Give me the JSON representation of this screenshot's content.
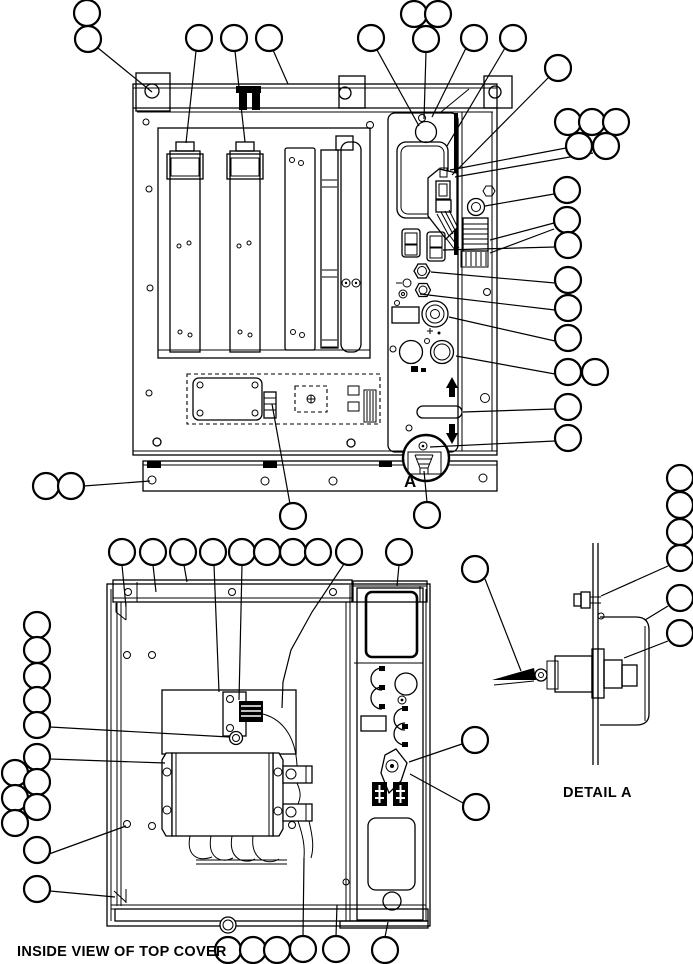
{
  "figure": {
    "type": "exploded-parts-diagram",
    "background_color": "#ffffff",
    "line_color": "#000000"
  },
  "captions": {
    "inside_view": "INSIDE VIEW OF TOP COVER",
    "detail_a": "DETAIL A",
    "detail_marker_a": "A"
  },
  "callouts": {
    "radius": 13,
    "stroke_width": 2.2,
    "fill": "#ffffff",
    "balloons": [
      [
        87,
        13
      ],
      [
        88,
        39
      ],
      [
        199,
        38
      ],
      [
        234,
        38
      ],
      [
        269,
        38
      ],
      [
        371,
        38
      ],
      [
        414,
        14
      ],
      [
        438,
        14
      ],
      [
        426,
        39
      ],
      [
        474,
        38
      ],
      [
        513,
        38
      ],
      [
        558,
        68
      ],
      [
        568,
        122
      ],
      [
        592,
        122
      ],
      [
        616,
        122
      ],
      [
        579,
        146
      ],
      [
        606,
        146
      ],
      [
        567,
        190
      ],
      [
        567,
        220
      ],
      [
        568,
        245
      ],
      [
        568,
        280
      ],
      [
        568,
        308
      ],
      [
        568,
        338
      ],
      [
        568,
        372
      ],
      [
        595,
        372
      ],
      [
        568,
        407
      ],
      [
        568,
        438
      ],
      [
        46,
        486
      ],
      [
        71,
        486
      ],
      [
        293,
        516
      ],
      [
        427,
        515
      ],
      [
        122,
        552
      ],
      [
        153,
        552
      ],
      [
        183,
        552
      ],
      [
        213,
        552
      ],
      [
        242,
        552
      ],
      [
        267,
        552
      ],
      [
        293,
        552
      ],
      [
        318,
        552
      ],
      [
        349,
        552
      ],
      [
        399,
        552
      ],
      [
        475,
        569
      ],
      [
        37,
        625
      ],
      [
        37,
        650
      ],
      [
        37,
        676
      ],
      [
        37,
        700
      ],
      [
        37,
        725
      ],
      [
        37,
        757
      ],
      [
        15,
        773
      ],
      [
        37,
        782
      ],
      [
        15,
        798
      ],
      [
        37,
        807
      ],
      [
        15,
        823
      ],
      [
        37,
        850
      ],
      [
        37,
        889
      ],
      [
        228,
        950
      ],
      [
        253,
        950
      ],
      [
        277,
        950
      ],
      [
        303,
        949
      ],
      [
        336,
        949
      ],
      [
        385,
        950
      ],
      [
        475,
        740
      ],
      [
        476,
        807
      ],
      [
        680,
        478
      ],
      [
        680,
        505
      ],
      [
        680,
        532
      ],
      [
        680,
        558
      ],
      [
        680,
        598
      ],
      [
        680,
        633
      ]
    ]
  },
  "leaders": {
    "stroke_width": 1.2,
    "lines": [
      [
        [
          98,
          48
        ],
        [
          152,
          92
        ]
      ],
      [
        [
          196,
          51
        ],
        [
          186,
          143
        ]
      ],
      [
        [
          235,
          51
        ],
        [
          245,
          142
        ]
      ],
      [
        [
          273,
          50
        ],
        [
          288,
          84
        ]
      ],
      [
        [
          377,
          50
        ],
        [
          419,
          126
        ]
      ],
      [
        [
          426,
          52
        ],
        [
          424,
          119
        ]
      ],
      [
        [
          466,
          48
        ],
        [
          432,
          117
        ]
      ],
      [
        [
          505,
          48
        ],
        [
          447,
          146
        ]
      ],
      [
        [
          549,
          77
        ],
        [
          452,
          175
        ]
      ],
      [
        [
          566,
          148
        ],
        [
          450,
          170
        ]
      ],
      [
        [
          593,
          153
        ],
        [
          455,
          177
        ]
      ],
      [
        [
          554,
          194
        ],
        [
          485,
          206
        ]
      ],
      [
        [
          554,
          223
        ],
        [
          490,
          240
        ]
      ],
      [
        [
          554,
          229
        ],
        [
          490,
          253
        ]
      ],
      [
        [
          555,
          247
        ],
        [
          443,
          250
        ]
      ],
      [
        [
          555,
          283
        ],
        [
          431,
          272
        ]
      ],
      [
        [
          555,
          310
        ],
        [
          420,
          294
        ]
      ],
      [
        [
          555,
          341
        ],
        [
          449,
          317
        ]
      ],
      [
        [
          555,
          374
        ],
        [
          456,
          356
        ]
      ],
      [
        [
          555,
          409
        ],
        [
          463,
          412
        ]
      ],
      [
        [
          555,
          441
        ],
        [
          430,
          447
        ]
      ],
      [
        [
          84,
          486
        ],
        [
          150,
          481
        ]
      ],
      [
        [
          290,
          504
        ],
        [
          272,
          404
        ]
      ],
      [
        [
          427,
          502
        ],
        [
          424,
          471
        ]
      ],
      [
        [
          122,
          565
        ],
        [
          126,
          607
        ]
      ],
      [
        [
          153,
          565
        ],
        [
          156,
          592
        ]
      ],
      [
        [
          184,
          565
        ],
        [
          187,
          582
        ]
      ],
      [
        [
          214,
          565
        ],
        [
          219,
          692
        ]
      ],
      [
        [
          242,
          565
        ],
        [
          239,
          700
        ]
      ],
      [
        [
          344,
          564
        ],
        [
          312,
          612
        ],
        [
          291,
          650
        ],
        [
          283,
          682
        ],
        [
          282,
          708
        ]
      ],
      [
        [
          399,
          565
        ],
        [
          397,
          586
        ]
      ],
      [
        [
          485,
          579
        ],
        [
          521,
          671
        ]
      ],
      [
        [
          50,
          727
        ],
        [
          229,
          737
        ]
      ],
      [
        [
          50,
          759
        ],
        [
          165,
          763
        ]
      ],
      [
        [
          49,
          854
        ],
        [
          126,
          826
        ]
      ],
      [
        [
          50,
          891
        ],
        [
          115,
          897
        ]
      ],
      [
        [
          303,
          936
        ],
        [
          304,
          858
        ]
      ],
      [
        [
          336,
          936
        ],
        [
          337,
          905
        ]
      ],
      [
        [
          385,
          937
        ],
        [
          388,
          922
        ]
      ],
      [
        [
          462,
          744
        ],
        [
          409,
          762
        ]
      ],
      [
        [
          463,
          803
        ],
        [
          410,
          774
        ]
      ],
      [
        [
          668,
          566
        ],
        [
          601,
          596
        ]
      ],
      [
        [
          668,
          606
        ],
        [
          645,
          620
        ]
      ],
      [
        [
          668,
          641
        ],
        [
          624,
          658
        ]
      ]
    ]
  }
}
